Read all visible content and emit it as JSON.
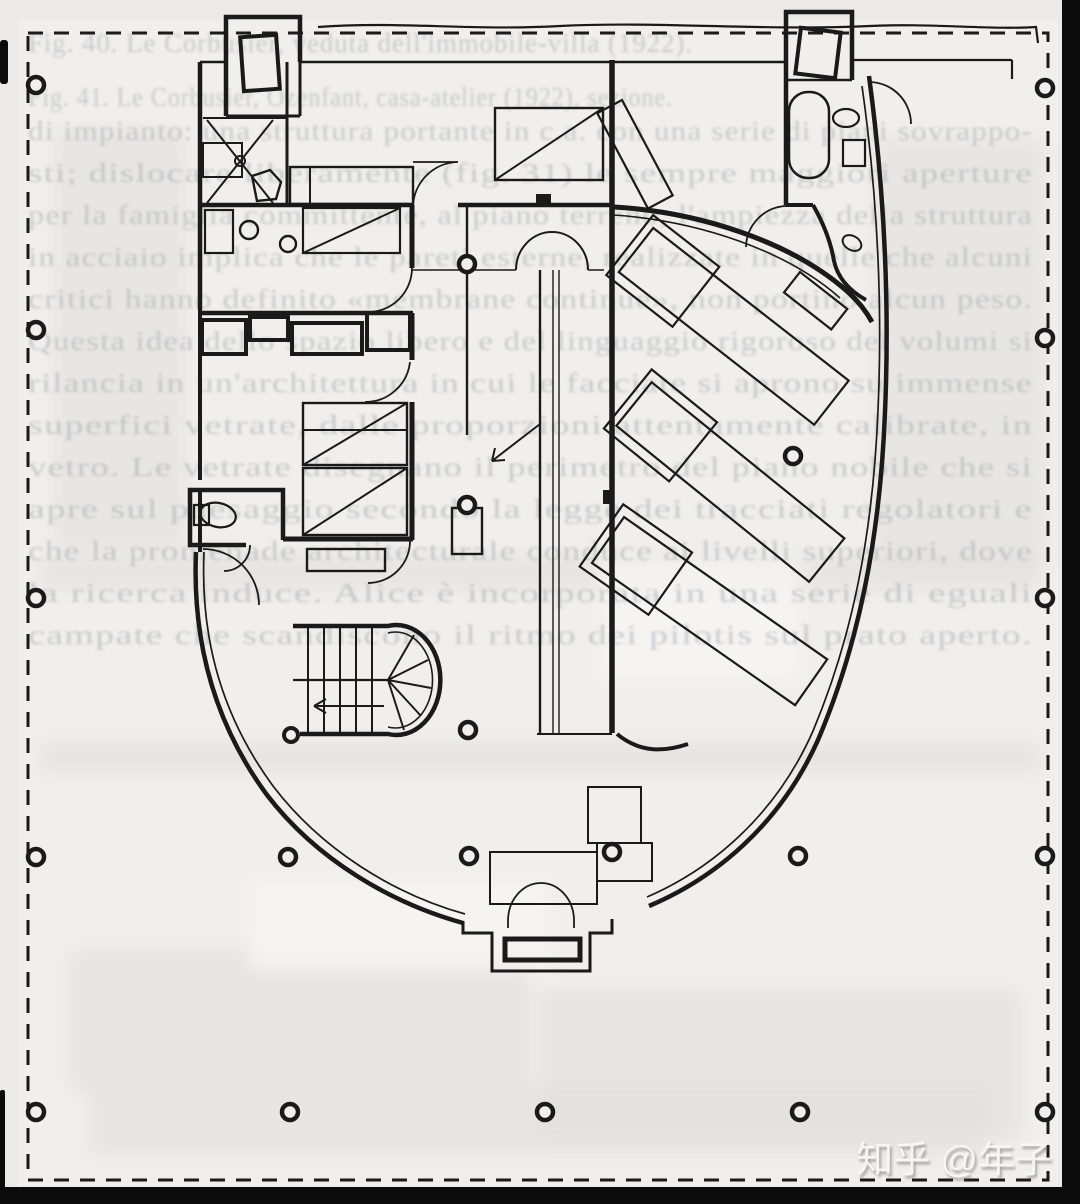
{
  "page": {
    "colors": {
      "page": "#ebeae6",
      "paper": "#f0efeb",
      "ink": "#1a1a1a",
      "ghost": "#a0a6af",
      "scan": "#0b0b0b",
      "watermark": "#f7f7f4"
    },
    "watermark": "知乎 @年子"
  },
  "ghost_text": {
    "caption_1": "Fig. 40. Le Corbusier, veduta dell'immobile-villa (1922).",
    "caption_2": "Fig. 41. Le Corbusier, Ozenfant, casa-atelier (1922), sezione.",
    "body_lines": [
      "di impianto: una struttura portante in c.a. con una serie di piani sovrappo-",
      "sti; dislocare liberamente (fig. 31) le sempre maggiori aperture",
      "per la famiglia committente, al piano terreno, l'ampiezza della struttura",
      "in acciaio implica che le pareti esterne, realizzate in quelle che alcuni",
      "critici hanno definito «membrane continue», non portino alcun peso.",
      "Questa idea dello spazio libero e del linguaggio rigoroso dei volumi si",
      "rilancia in un'architettura in cui le facciate si aprono su immense",
      "superfici vetrate, dalle proporzioni attentamente calibrate, in",
      "vetro. Le vetrate disegnano il perimetro del piano nobile che si",
      "apre sul paesaggio secondo la legge dei tracciati regolatori e",
      "che la promenade architecturale conduce ai livelli superiori, dove",
      "la ricerca induce. Alice è incorporata in una serie di eguali",
      "campate che scandiscono il ritmo dei pilotis sul prato aperto."
    ]
  }
}
